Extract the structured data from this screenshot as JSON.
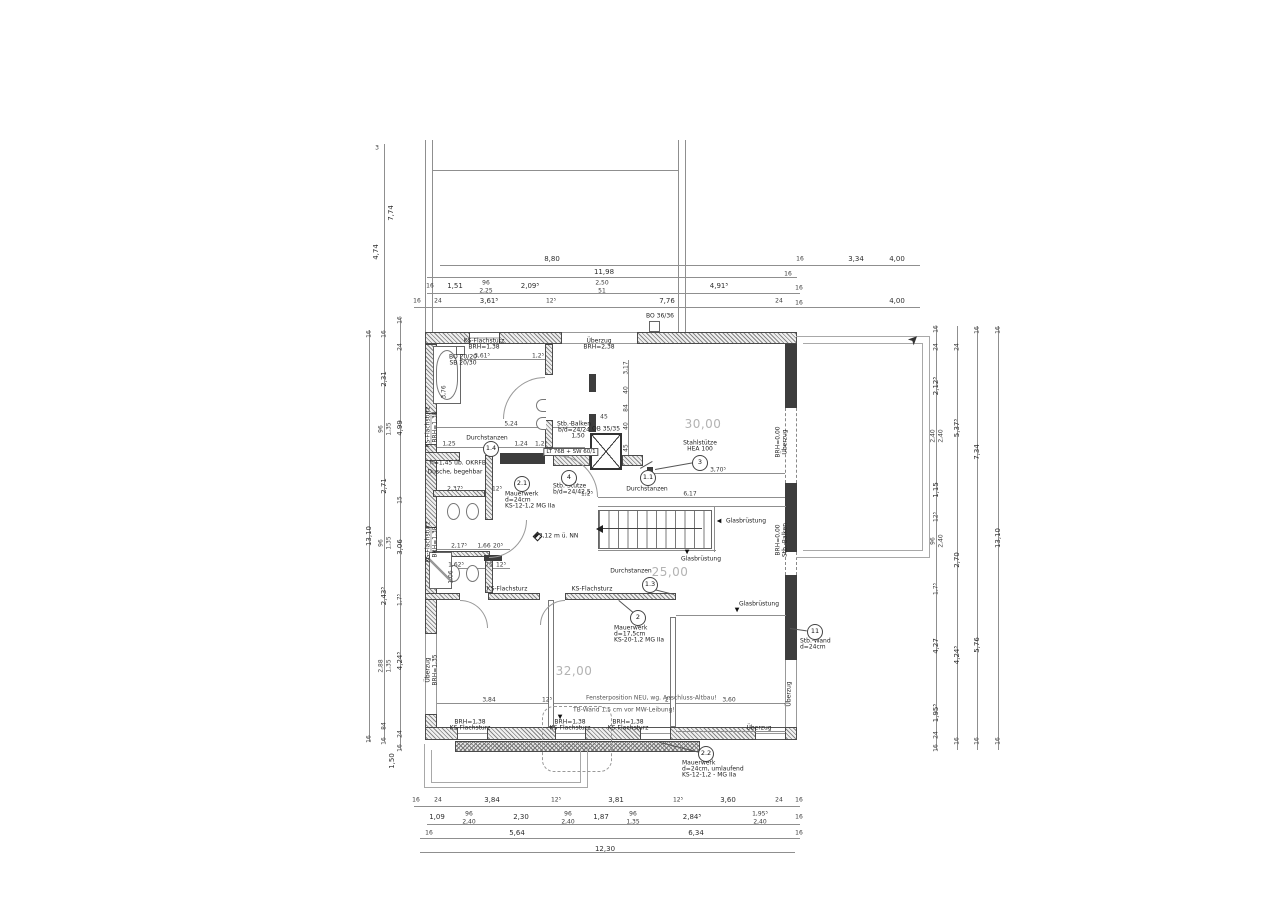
{
  "drawing": {
    "kind": "structural floor plan (Grundriss)",
    "room_area_labels": [
      "30,00",
      "32,00",
      "25,00"
    ],
    "colors": {
      "line": "#555555",
      "concrete_wall": "#3d3d3d",
      "masonry_hatch": "#868686",
      "room_label": "#b3b3b3",
      "text": "#222222"
    }
  },
  "callouts": [
    {
      "n": "1.4",
      "x": 490,
      "y": 448
    },
    {
      "n": "2.1",
      "x": 521,
      "y": 483
    },
    {
      "n": "4",
      "x": 568,
      "y": 477
    },
    {
      "n": "1.1",
      "x": 647,
      "y": 477
    },
    {
      "n": "3",
      "x": 699,
      "y": 462
    },
    {
      "n": "1.3",
      "x": 649,
      "y": 584
    },
    {
      "n": "2",
      "x": 637,
      "y": 617
    },
    {
      "n": "11",
      "x": 814,
      "y": 631
    },
    {
      "n": "2.2",
      "x": 705,
      "y": 753
    }
  ],
  "dim_labels": [
    {
      "t": "8,80",
      "x": 552,
      "y": 259
    },
    {
      "t": "3,34",
      "x": 856,
      "y": 259
    },
    {
      "t": "16",
      "x": 800,
      "y": 259,
      "s": 1
    },
    {
      "t": "4,00",
      "x": 897,
      "y": 259
    },
    {
      "t": "11,98",
      "x": 604,
      "y": 272
    },
    {
      "t": "16",
      "x": 788,
      "y": 274,
      "s": 1
    },
    {
      "t": "16",
      "x": 430,
      "y": 286,
      "s": 1
    },
    {
      "t": "1,51",
      "x": 455,
      "y": 286
    },
    {
      "t": "96",
      "x": 486,
      "y": 283,
      "s": 1
    },
    {
      "t": "2,25",
      "x": 486,
      "y": 291,
      "s": 1
    },
    {
      "t": "2,09⁵",
      "x": 530,
      "y": 286
    },
    {
      "t": "2,50",
      "x": 602,
      "y": 283,
      "s": 1
    },
    {
      "t": "51",
      "x": 602,
      "y": 291,
      "s": 1
    },
    {
      "t": "4,91⁵",
      "x": 719,
      "y": 286
    },
    {
      "t": "16",
      "x": 799,
      "y": 288,
      "s": 1
    },
    {
      "t": "16",
      "x": 417,
      "y": 301,
      "s": 1
    },
    {
      "t": "24",
      "x": 438,
      "y": 301,
      "s": 1
    },
    {
      "t": "3,61⁵",
      "x": 489,
      "y": 301
    },
    {
      "t": "12⁵",
      "x": 551,
      "y": 301,
      "s": 1
    },
    {
      "t": "7,76",
      "x": 667,
      "y": 301
    },
    {
      "t": "24",
      "x": 779,
      "y": 301,
      "s": 1
    },
    {
      "t": "16",
      "x": 799,
      "y": 303,
      "s": 1
    },
    {
      "t": "4,00",
      "x": 897,
      "y": 301
    },
    {
      "t": "16",
      "x": 416,
      "y": 800,
      "s": 1
    },
    {
      "t": "24",
      "x": 438,
      "y": 800,
      "s": 1
    },
    {
      "t": "3,84",
      "x": 492,
      "y": 800
    },
    {
      "t": "12⁵",
      "x": 556,
      "y": 800,
      "s": 1
    },
    {
      "t": "3,81",
      "x": 616,
      "y": 800
    },
    {
      "t": "12⁵",
      "x": 678,
      "y": 800,
      "s": 1
    },
    {
      "t": "3,60",
      "x": 728,
      "y": 800
    },
    {
      "t": "24",
      "x": 779,
      "y": 800,
      "s": 1
    },
    {
      "t": "16",
      "x": 799,
      "y": 800,
      "s": 1
    },
    {
      "t": "1,09",
      "x": 437,
      "y": 817
    },
    {
      "t": "96",
      "x": 469,
      "y": 814,
      "s": 1
    },
    {
      "t": "2,40",
      "x": 469,
      "y": 822,
      "s": 1
    },
    {
      "t": "2,30",
      "x": 521,
      "y": 817
    },
    {
      "t": "96",
      "x": 568,
      "y": 814,
      "s": 1
    },
    {
      "t": "2,40",
      "x": 568,
      "y": 822,
      "s": 1
    },
    {
      "t": "1,87",
      "x": 601,
      "y": 817
    },
    {
      "t": "96",
      "x": 633,
      "y": 814,
      "s": 1
    },
    {
      "t": "1,35",
      "x": 633,
      "y": 822,
      "s": 1
    },
    {
      "t": "2,84⁵",
      "x": 692,
      "y": 817
    },
    {
      "t": "1,95⁵",
      "x": 760,
      "y": 814,
      "s": 1
    },
    {
      "t": "2,40",
      "x": 760,
      "y": 822,
      "s": 1
    },
    {
      "t": "16",
      "x": 799,
      "y": 817,
      "s": 1
    },
    {
      "t": "16",
      "x": 429,
      "y": 833,
      "s": 1
    },
    {
      "t": "5,64",
      "x": 517,
      "y": 833
    },
    {
      "t": "6,34",
      "x": 696,
      "y": 833
    },
    {
      "t": "16",
      "x": 799,
      "y": 833,
      "s": 1
    },
    {
      "t": "12,30",
      "x": 605,
      "y": 849
    },
    {
      "t": "3",
      "x": 377,
      "y": 148,
      "s": 1
    },
    {
      "t": "7,74",
      "x": 391,
      "y": 213,
      "r": 1
    },
    {
      "t": "4,74",
      "x": 376,
      "y": 252,
      "r": 1
    },
    {
      "t": "16",
      "x": 369,
      "y": 334,
      "r": 1,
      "s": 1
    },
    {
      "t": "13,10",
      "x": 369,
      "y": 536,
      "r": 1
    },
    {
      "t": "16",
      "x": 369,
      "y": 739,
      "r": 1,
      "s": 1
    },
    {
      "t": "16",
      "x": 384,
      "y": 334,
      "r": 1,
      "s": 1
    },
    {
      "t": "2,31",
      "x": 384,
      "y": 379,
      "r": 1
    },
    {
      "t": "96",
      "x": 381,
      "y": 429,
      "r": 1,
      "s": 1
    },
    {
      "t": "1,35",
      "x": 389,
      "y": 429,
      "r": 1,
      "s": 1
    },
    {
      "t": "2,71",
      "x": 384,
      "y": 486,
      "r": 1
    },
    {
      "t": "96",
      "x": 381,
      "y": 543,
      "r": 1,
      "s": 1
    },
    {
      "t": "1,35",
      "x": 389,
      "y": 543,
      "r": 1,
      "s": 1
    },
    {
      "t": "2,43⁵",
      "x": 384,
      "y": 596,
      "r": 1
    },
    {
      "t": "2,88",
      "x": 381,
      "y": 666,
      "r": 1,
      "s": 1
    },
    {
      "t": "1,35",
      "x": 389,
      "y": 666,
      "r": 1,
      "s": 1
    },
    {
      "t": "84",
      "x": 384,
      "y": 726,
      "r": 1,
      "s": 1
    },
    {
      "t": "16",
      "x": 384,
      "y": 741,
      "r": 1,
      "s": 1
    },
    {
      "t": "16",
      "x": 400,
      "y": 320,
      "r": 1,
      "s": 1
    },
    {
      "t": "24",
      "x": 400,
      "y": 347,
      "r": 1,
      "s": 1
    },
    {
      "t": "4,99",
      "x": 400,
      "y": 428,
      "r": 1
    },
    {
      "t": "15",
      "x": 400,
      "y": 500,
      "r": 1,
      "s": 1
    },
    {
      "t": "3,06",
      "x": 400,
      "y": 547,
      "r": 1
    },
    {
      "t": "1,7⁵",
      "x": 400,
      "y": 600,
      "r": 1,
      "s": 1
    },
    {
      "t": "4,24⁵",
      "x": 400,
      "y": 661,
      "r": 1
    },
    {
      "t": "24",
      "x": 400,
      "y": 734,
      "r": 1,
      "s": 1
    },
    {
      "t": "16",
      "x": 400,
      "y": 748,
      "r": 1,
      "s": 1
    },
    {
      "t": "1,50",
      "x": 392,
      "y": 761,
      "r": 1
    },
    {
      "t": "16",
      "x": 936,
      "y": 329,
      "r": 1,
      "s": 1
    },
    {
      "t": "24",
      "x": 936,
      "y": 347,
      "r": 1,
      "s": 1
    },
    {
      "t": "2,12⁵",
      "x": 936,
      "y": 386,
      "r": 1
    },
    {
      "t": "2,40",
      "x": 933,
      "y": 436,
      "r": 1,
      "s": 1
    },
    {
      "t": "2,40",
      "x": 941,
      "y": 436,
      "r": 1,
      "s": 1
    },
    {
      "t": "1,15",
      "x": 936,
      "y": 490,
      "r": 1
    },
    {
      "t": "12⁵",
      "x": 936,
      "y": 517,
      "r": 1,
      "s": 1
    },
    {
      "t": "96",
      "x": 933,
      "y": 541,
      "r": 1,
      "s": 1
    },
    {
      "t": "2,40",
      "x": 941,
      "y": 541,
      "r": 1,
      "s": 1
    },
    {
      "t": "1,7⁵",
      "x": 936,
      "y": 589,
      "r": 1,
      "s": 1
    },
    {
      "t": "4,27",
      "x": 936,
      "y": 646,
      "r": 1
    },
    {
      "t": "1,95⁵",
      "x": 936,
      "y": 713,
      "r": 1
    },
    {
      "t": "24",
      "x": 936,
      "y": 735,
      "r": 1,
      "s": 1
    },
    {
      "t": "16",
      "x": 936,
      "y": 748,
      "r": 1,
      "s": 1
    },
    {
      "t": "24",
      "x": 957,
      "y": 347,
      "r": 1,
      "s": 1
    },
    {
      "t": "5,37⁵",
      "x": 957,
      "y": 428,
      "r": 1
    },
    {
      "t": "2,70",
      "x": 957,
      "y": 560,
      "r": 1
    },
    {
      "t": "4,24⁵",
      "x": 957,
      "y": 655,
      "r": 1
    },
    {
      "t": "16",
      "x": 957,
      "y": 741,
      "r": 1,
      "s": 1
    },
    {
      "t": "16",
      "x": 977,
      "y": 330,
      "r": 1,
      "s": 1
    },
    {
      "t": "7,34",
      "x": 977,
      "y": 452,
      "r": 1
    },
    {
      "t": "5,76",
      "x": 977,
      "y": 645,
      "r": 1
    },
    {
      "t": "16",
      "x": 977,
      "y": 741,
      "r": 1,
      "s": 1
    },
    {
      "t": "16",
      "x": 998,
      "y": 330,
      "r": 1,
      "s": 1
    },
    {
      "t": "13,10",
      "x": 998,
      "y": 538,
      "r": 1
    },
    {
      "t": "16",
      "x": 998,
      "y": 741,
      "r": 1,
      "s": 1
    },
    {
      "t": "3,61⁵",
      "x": 482,
      "y": 356,
      "s": 1
    },
    {
      "t": "1,2⁵",
      "x": 538,
      "y": 356,
      "s": 1
    },
    {
      "t": "3,76",
      "x": 444,
      "y": 392,
      "r": 1,
      "s": 1
    },
    {
      "t": "5,24",
      "x": 511,
      "y": 424,
      "s": 1
    },
    {
      "t": "1,25",
      "x": 449,
      "y": 444,
      "s": 1
    },
    {
      "t": "1,24",
      "x": 521,
      "y": 444,
      "s": 1
    },
    {
      "t": "1,2⁵",
      "x": 541,
      "y": 444,
      "s": 1
    },
    {
      "t": "3,17",
      "x": 626,
      "y": 368,
      "r": 1,
      "s": 1
    },
    {
      "t": "40",
      "x": 626,
      "y": 390,
      "r": 1,
      "s": 1
    },
    {
      "t": "84",
      "x": 626,
      "y": 408,
      "r": 1,
      "s": 1
    },
    {
      "t": "40",
      "x": 626,
      "y": 426,
      "r": 1,
      "s": 1
    },
    {
      "t": "45",
      "x": 626,
      "y": 448,
      "r": 1,
      "s": 1
    },
    {
      "t": "45",
      "x": 604,
      "y": 417,
      "s": 1
    },
    {
      "t": "3,70⁵",
      "x": 718,
      "y": 470,
      "s": 1
    },
    {
      "t": "6,17",
      "x": 690,
      "y": 494,
      "s": 1
    },
    {
      "t": "1,2⁵",
      "x": 587,
      "y": 494,
      "s": 1
    },
    {
      "t": "2,37⁵",
      "x": 455,
      "y": 489,
      "s": 1
    },
    {
      "t": "12⁵",
      "x": 497,
      "y": 489,
      "s": 1
    },
    {
      "t": "2,17⁵",
      "x": 459,
      "y": 546,
      "s": 1
    },
    {
      "t": "1,66",
      "x": 484,
      "y": 546,
      "s": 1
    },
    {
      "t": "20⁵",
      "x": 498,
      "y": 546,
      "s": 1
    },
    {
      "t": "1,62⁵",
      "x": 456,
      "y": 565,
      "s": 1
    },
    {
      "t": "75",
      "x": 489,
      "y": 565,
      "s": 1
    },
    {
      "t": "12⁵",
      "x": 501,
      "y": 565,
      "s": 1
    },
    {
      "t": "1,06",
      "x": 451,
      "y": 577,
      "r": 1,
      "s": 1
    },
    {
      "t": "3,84",
      "x": 489,
      "y": 700,
      "s": 1
    },
    {
      "t": "12⁵",
      "x": 547,
      "y": 700,
      "s": 1
    },
    {
      "t": "2⁵",
      "x": 668,
      "y": 700,
      "s": 1
    },
    {
      "t": "3,60",
      "x": 729,
      "y": 700,
      "s": 1
    }
  ],
  "text_labels": [
    {
      "t": "30,00",
      "x": 703,
      "y": 424,
      "cls": "room"
    },
    {
      "t": "32,00",
      "x": 574,
      "y": 671,
      "cls": "room"
    },
    {
      "t": "25,00",
      "x": 670,
      "y": 572,
      "cls": "room"
    },
    {
      "t": "KS-Flachsturz",
      "x": 484,
      "y": 341
    },
    {
      "t": "BRH=1,38",
      "x": 484,
      "y": 347
    },
    {
      "t": "Überzug",
      "x": 599,
      "y": 341
    },
    {
      "t": "BRH=2,38",
      "x": 599,
      "y": 347
    },
    {
      "t": "BO 20/20",
      "x": 463,
      "y": 357
    },
    {
      "t": "SB 20/30",
      "x": 463,
      "y": 363
    },
    {
      "t": "BO 36/36",
      "x": 660,
      "y": 316
    },
    {
      "t": "KS-Flachsturz",
      "x": 428,
      "y": 427,
      "r": 1
    },
    {
      "t": "BRH=1,38",
      "x": 435,
      "y": 427,
      "r": 1
    },
    {
      "t": "KS-Flachsturz",
      "x": 428,
      "y": 542,
      "r": 1
    },
    {
      "t": "BRH=1,38",
      "x": 435,
      "y": 542,
      "r": 1
    },
    {
      "t": "Überzug",
      "x": 428,
      "y": 670,
      "r": 1
    },
    {
      "t": "BRH=1,35",
      "x": 435,
      "y": 670,
      "r": 1
    },
    {
      "t": "Durchstanzen",
      "x": 487,
      "y": 438
    },
    {
      "t": "Stb.-Balken",
      "x": 574,
      "y": 424
    },
    {
      "t": "b/d=24/24",
      "x": 574,
      "y": 430
    },
    {
      "t": "1,50",
      "x": 578,
      "y": 436
    },
    {
      "t": "LT 76B + SW 60/1",
      "x": 571,
      "y": 452,
      "cls": "box"
    },
    {
      "t": "OB 35/35",
      "x": 606,
      "y": 429
    },
    {
      "t": "Stahlstütze",
      "x": 700,
      "y": 443
    },
    {
      "t": "HEA 100",
      "x": 700,
      "y": 449
    },
    {
      "t": "Durchstanzen",
      "x": 647,
      "y": 489
    },
    {
      "t": "Durchstanzen",
      "x": 631,
      "y": 571
    },
    {
      "t": "Mauerwerk",
      "x": 505,
      "y": 494,
      "a": 1
    },
    {
      "t": "d=24cm",
      "x": 505,
      "y": 500,
      "a": 1
    },
    {
      "t": "KS-12-1,2 MG IIa",
      "x": 505,
      "y": 506,
      "a": 1
    },
    {
      "t": "Stb.-Stütze",
      "x": 553,
      "y": 486,
      "a": 1
    },
    {
      "t": "b/d=24/42,5",
      "x": 553,
      "y": 492,
      "a": 1
    },
    {
      "t": "Mauerwerk",
      "x": 614,
      "y": 628,
      "a": 1
    },
    {
      "t": "d=17,5cm",
      "x": 614,
      "y": 634,
      "a": 1
    },
    {
      "t": "KS-20-1,2 MG IIa",
      "x": 614,
      "y": 640,
      "a": 1
    },
    {
      "t": "Stb.-Wand",
      "x": 800,
      "y": 641,
      "a": 1
    },
    {
      "t": "d=24cm",
      "x": 800,
      "y": 647,
      "a": 1
    },
    {
      "t": "Mauerwerk",
      "x": 682,
      "y": 763,
      "a": 1
    },
    {
      "t": "d=24cm, umlaufend",
      "x": 682,
      "y": 769,
      "a": 1
    },
    {
      "t": "KS-12-1,2 - MG IIa",
      "x": 682,
      "y": 775,
      "a": 1
    },
    {
      "t": "Glasbrüstung",
      "x": 746,
      "y": 521
    },
    {
      "t": "◀",
      "x": 719,
      "y": 521,
      "cls": "ar"
    },
    {
      "t": "Glasbrüstung",
      "x": 701,
      "y": 559
    },
    {
      "t": "▼",
      "x": 687,
      "y": 552,
      "cls": "ar"
    },
    {
      "t": "Glasbrüstung",
      "x": 759,
      "y": 604
    },
    {
      "t": "▼",
      "x": 737,
      "y": 610,
      "cls": "ar"
    },
    {
      "t": "Überzug",
      "x": 759,
      "y": 728
    },
    {
      "t": "Überzug",
      "x": 789,
      "y": 694,
      "r": 1
    },
    {
      "t": "BRH=0,00",
      "x": 778,
      "y": 442,
      "r": 1
    },
    {
      "t": "Überzug",
      "x": 785,
      "y": 442,
      "r": 1
    },
    {
      "t": "BRH=0,00",
      "x": 778,
      "y": 540,
      "r": 1
    },
    {
      "t": "Stb.-Balken",
      "x": 785,
      "y": 540,
      "r": 1
    },
    {
      "t": "KS-Flachsturz",
      "x": 507,
      "y": 589
    },
    {
      "t": "KS-Flachsturz",
      "x": 592,
      "y": 589
    },
    {
      "t": "BRH=1,38",
      "x": 470,
      "y": 722
    },
    {
      "t": "KS-Flachsturz",
      "x": 470,
      "y": 728
    },
    {
      "t": "BRH=1,38",
      "x": 570,
      "y": 722
    },
    {
      "t": "KS-Flachsturz",
      "x": 570,
      "y": 728
    },
    {
      "t": "BRH=1,38",
      "x": 628,
      "y": 722
    },
    {
      "t": "KS-Flachsturz",
      "x": 628,
      "y": 728
    },
    {
      "t": "Fensterposition NEU, wg. Anschluss-Altbau!",
      "x": 586,
      "y": 698,
      "a": 1,
      "cls": "gray"
    },
    {
      "t": "TB-Wand 1,5 cm vor MW-Leibung!",
      "x": 573,
      "y": 710,
      "a": 1,
      "cls": "gray"
    },
    {
      "t": "▼",
      "x": 560,
      "y": 717,
      "cls": "ar"
    },
    {
      "t": "h=1,45 üb. OKRFB",
      "x": 458,
      "y": 463
    },
    {
      "t": "Dusche, begehbar",
      "x": 455,
      "y": 472
    },
    {
      "t": "+3,12 m ü. NN",
      "x": 556,
      "y": 536
    },
    {
      "t": "➤",
      "x": 914,
      "y": 340,
      "cls": "north"
    }
  ]
}
